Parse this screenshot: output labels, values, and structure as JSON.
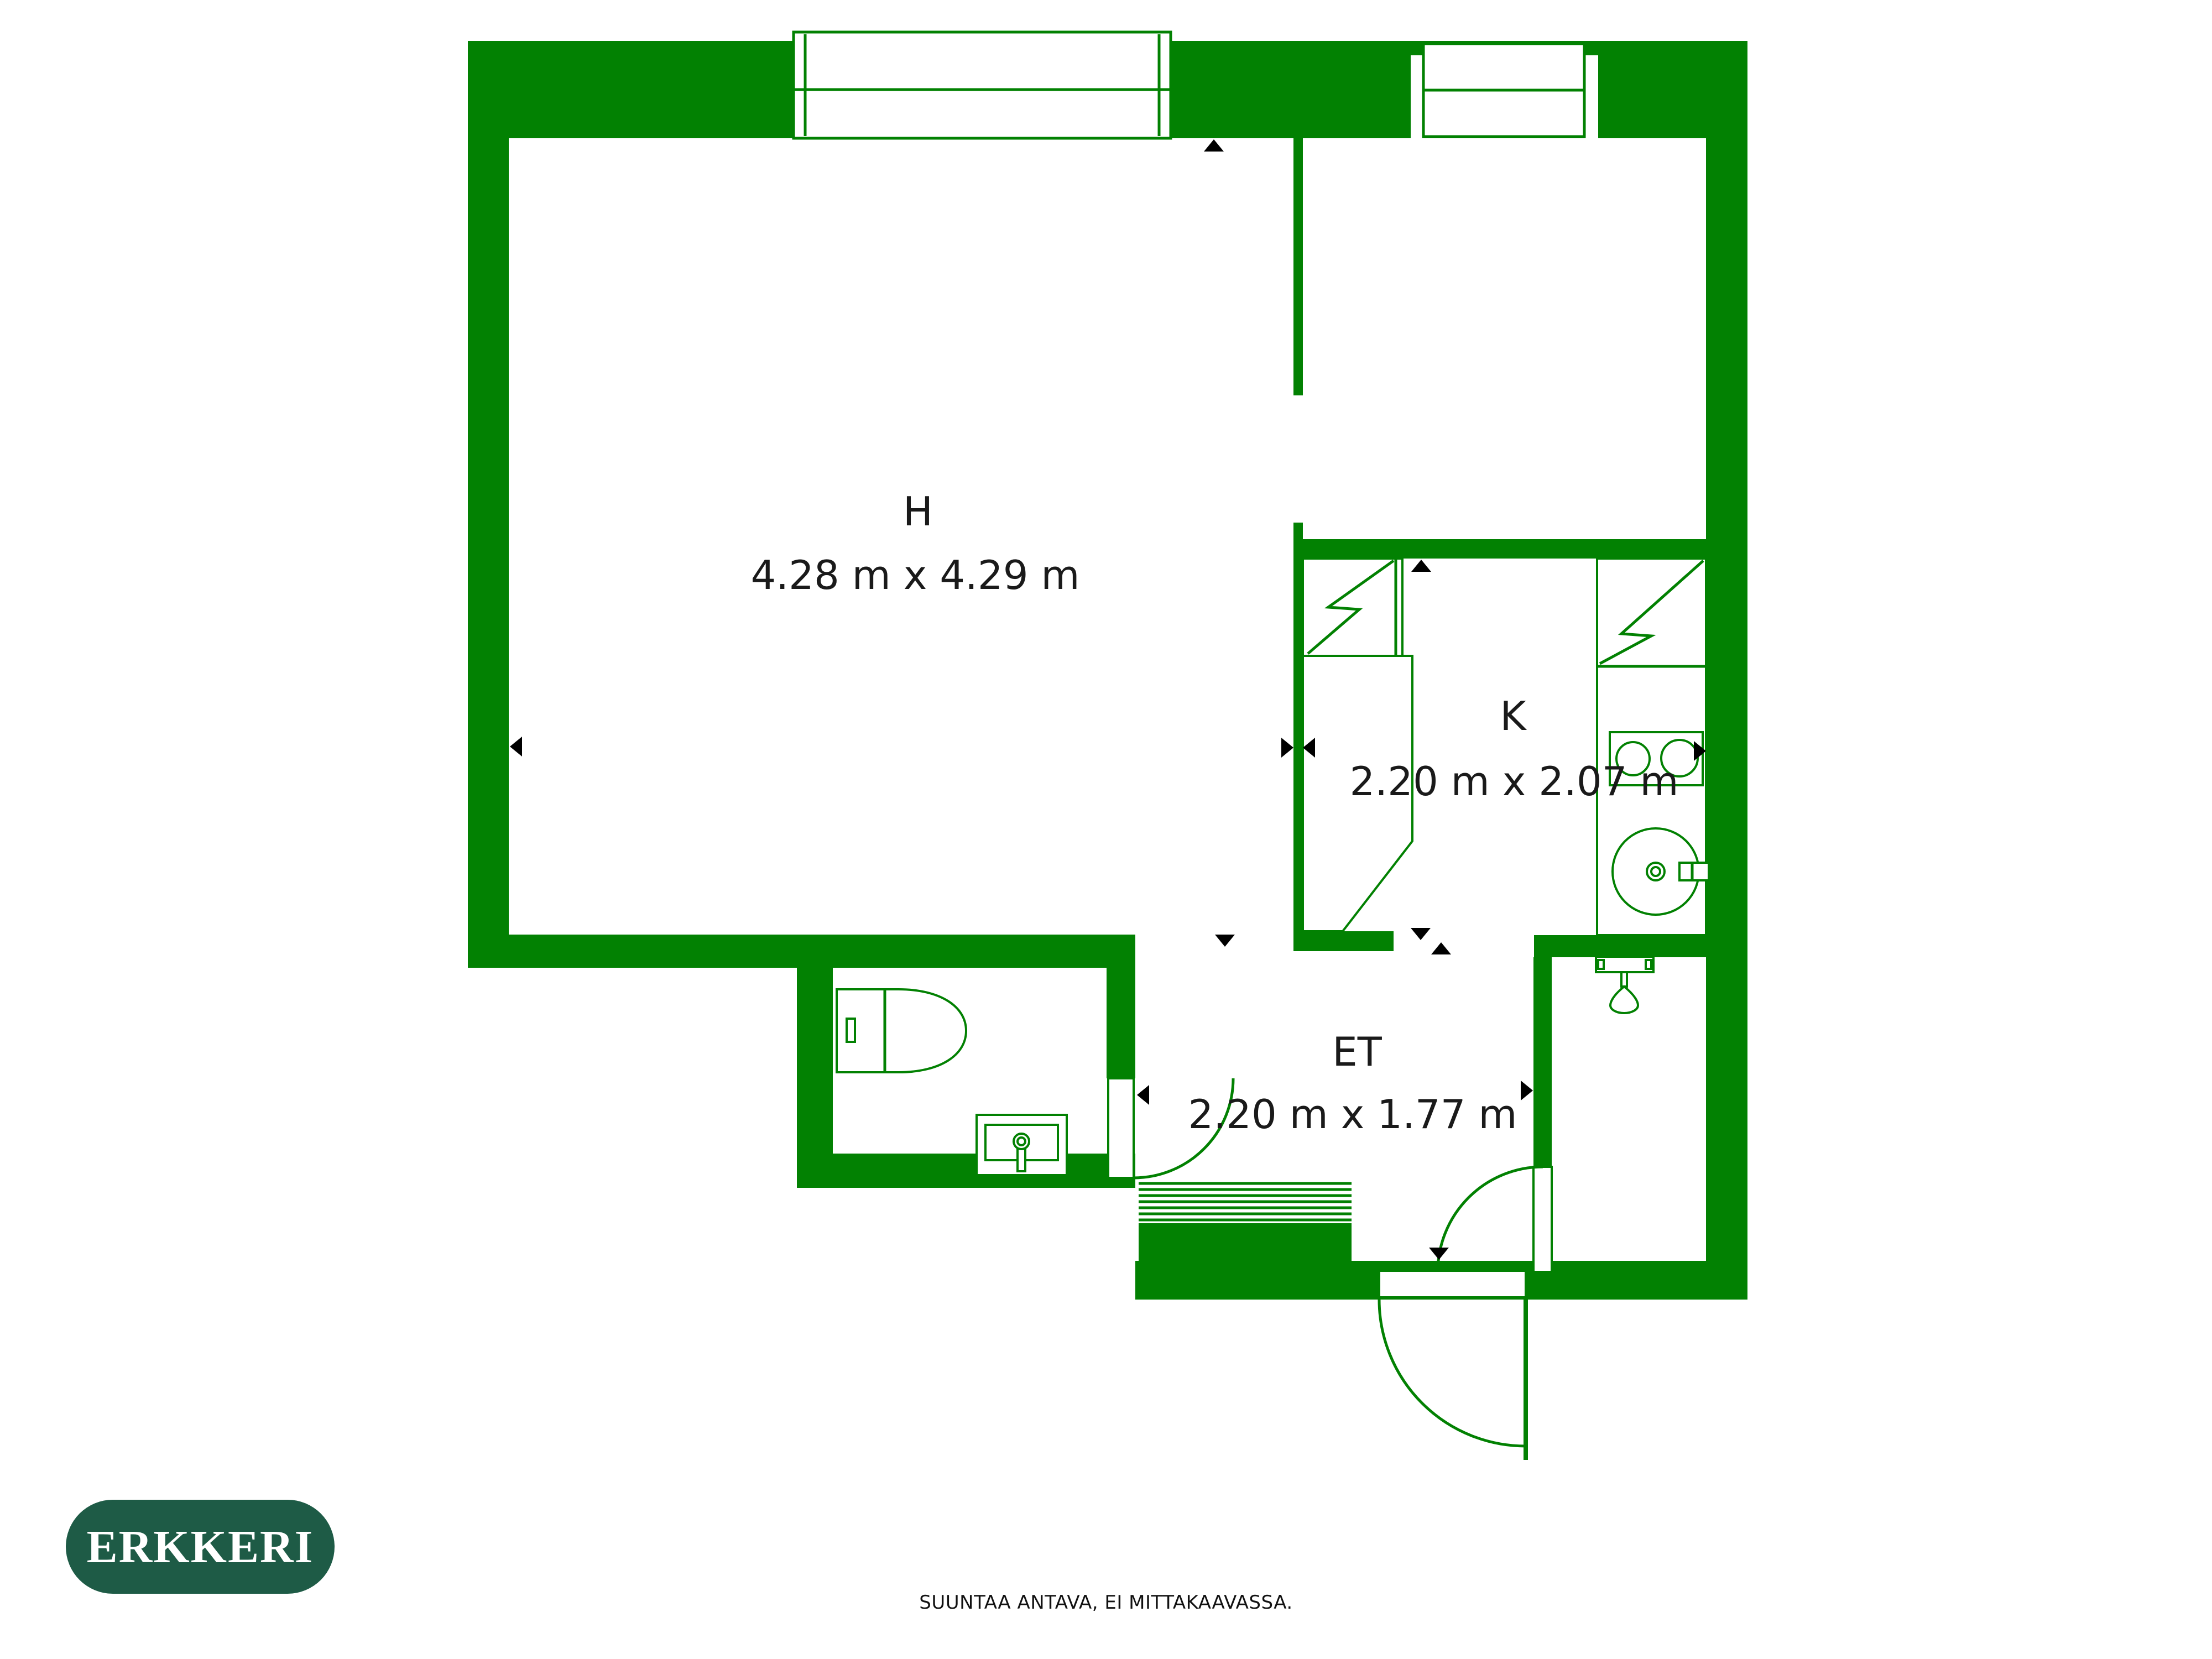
{
  "plan": {
    "colors": {
      "wall": "#028102",
      "arrow": "#000000",
      "label": "#1a1a1a"
    },
    "rooms": [
      {
        "code": "H",
        "dimensions": "4.28 m x 4.29 m"
      },
      {
        "code": "K",
        "dimensions": "2.20 m x 2.07 m"
      },
      {
        "code": "ET",
        "dimensions": "2.20 m x 1.77 m"
      }
    ],
    "icons": [
      "window-icon",
      "toilet-icon",
      "bathroom-sink-icon",
      "stove-icon",
      "kitchen-sink-icon",
      "shower-icon",
      "door-swing-icon",
      "stairs-icon",
      "dimension-arrow-icon"
    ]
  },
  "logo": {
    "text": "ERKKERI",
    "bg": "#1E5B46",
    "fg": "#FFFFFF"
  },
  "footer": {
    "disclaimer": "SUUNTAA ANTAVA, EI MITTAKAAVASSA."
  }
}
